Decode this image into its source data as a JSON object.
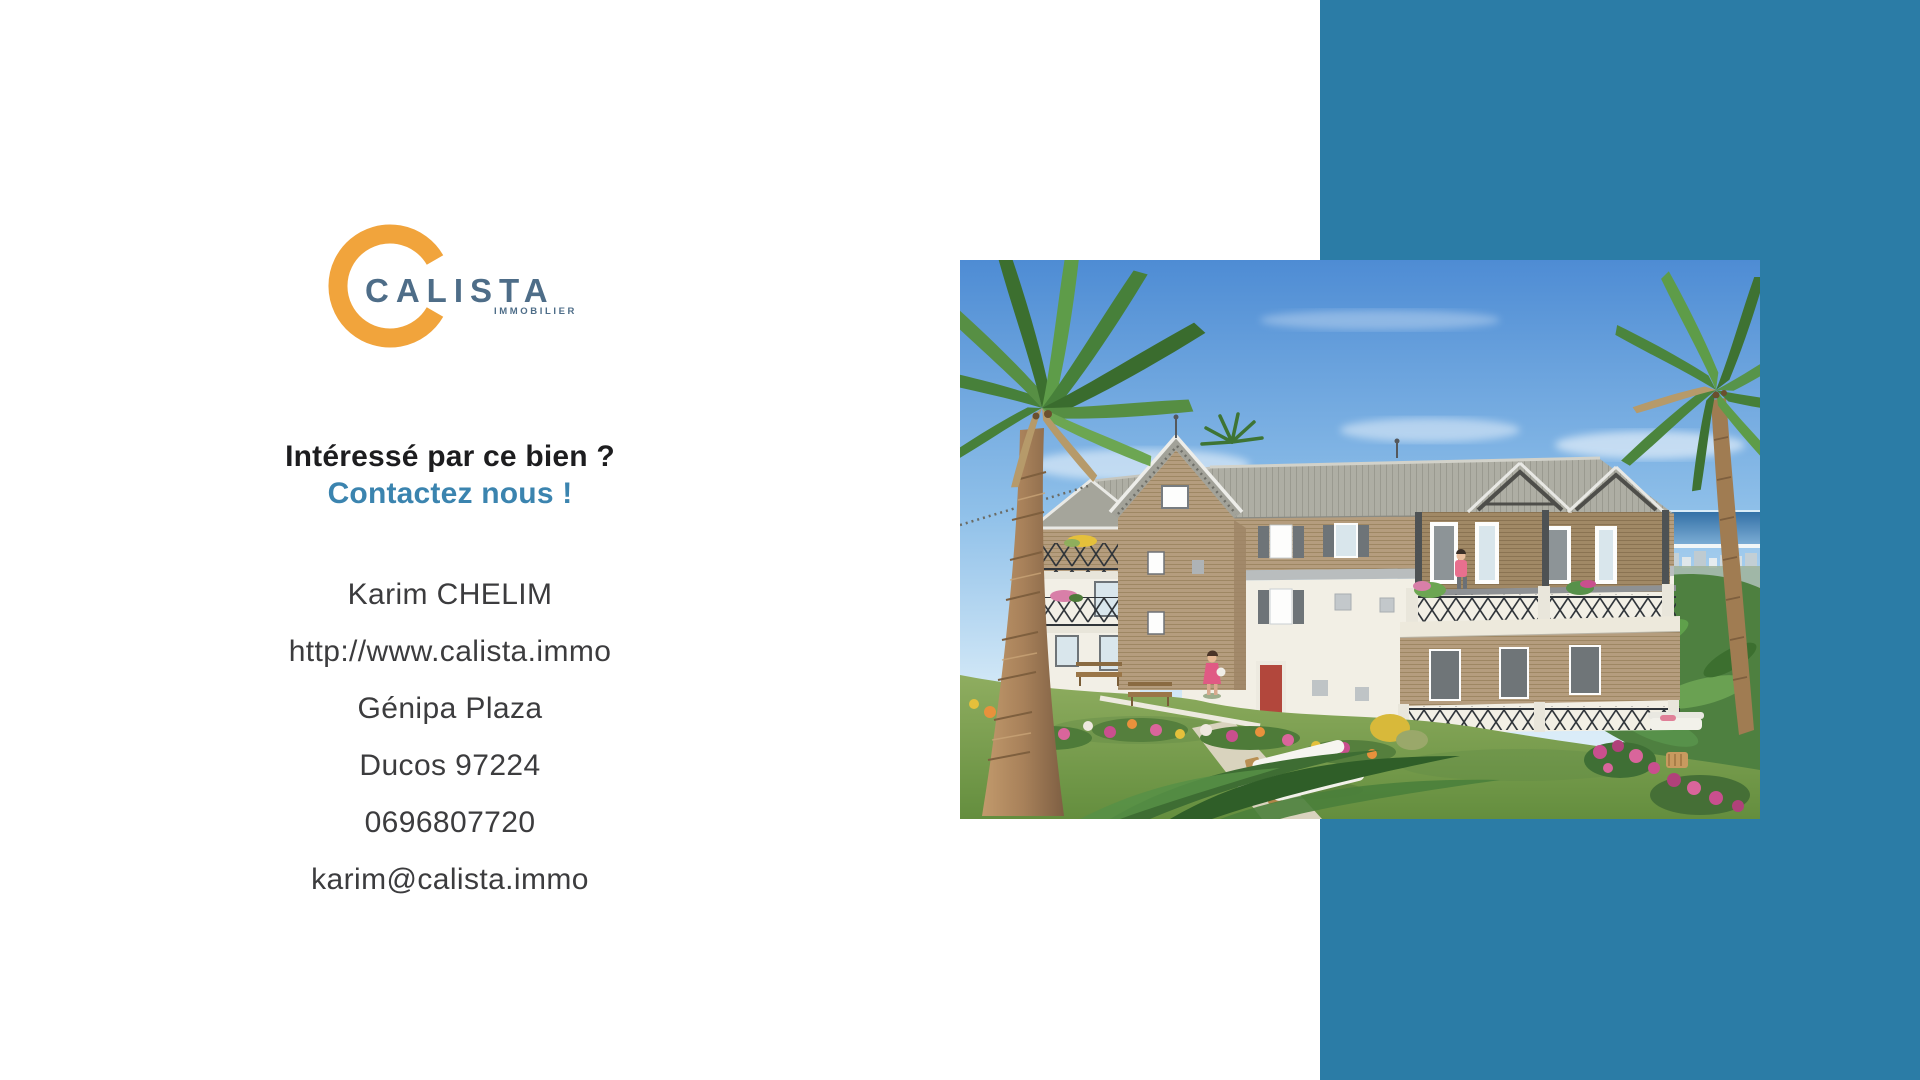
{
  "colors": {
    "accent_band": "#2B7CA6",
    "brand_orange": "#F1A43C",
    "brand_slate": "#4E6D88",
    "cta_blue": "#3B84AF",
    "heading_dark": "#1D1D1F",
    "text_dark": "#3C3C3E"
  },
  "brand": {
    "name": "CALISTA",
    "tagline": "IMMOBILIER",
    "logo_icon": "open-ring"
  },
  "cta": {
    "heading": "Intéressé par ce bien ?",
    "subheading": "Contactez nous !"
  },
  "contact": {
    "name": "Karim CHELIM",
    "website": "http://www.calista.immo",
    "address_line1": "Génipa Plaza",
    "address_line2": "Ducos 97224",
    "phone": "0696807720",
    "email": "karim@calista.immo"
  },
  "property_image": {
    "description": "3D architectural rendering of a tropical apartment residence with palm trees, flower garden, sun loungers and a distant sea view"
  }
}
